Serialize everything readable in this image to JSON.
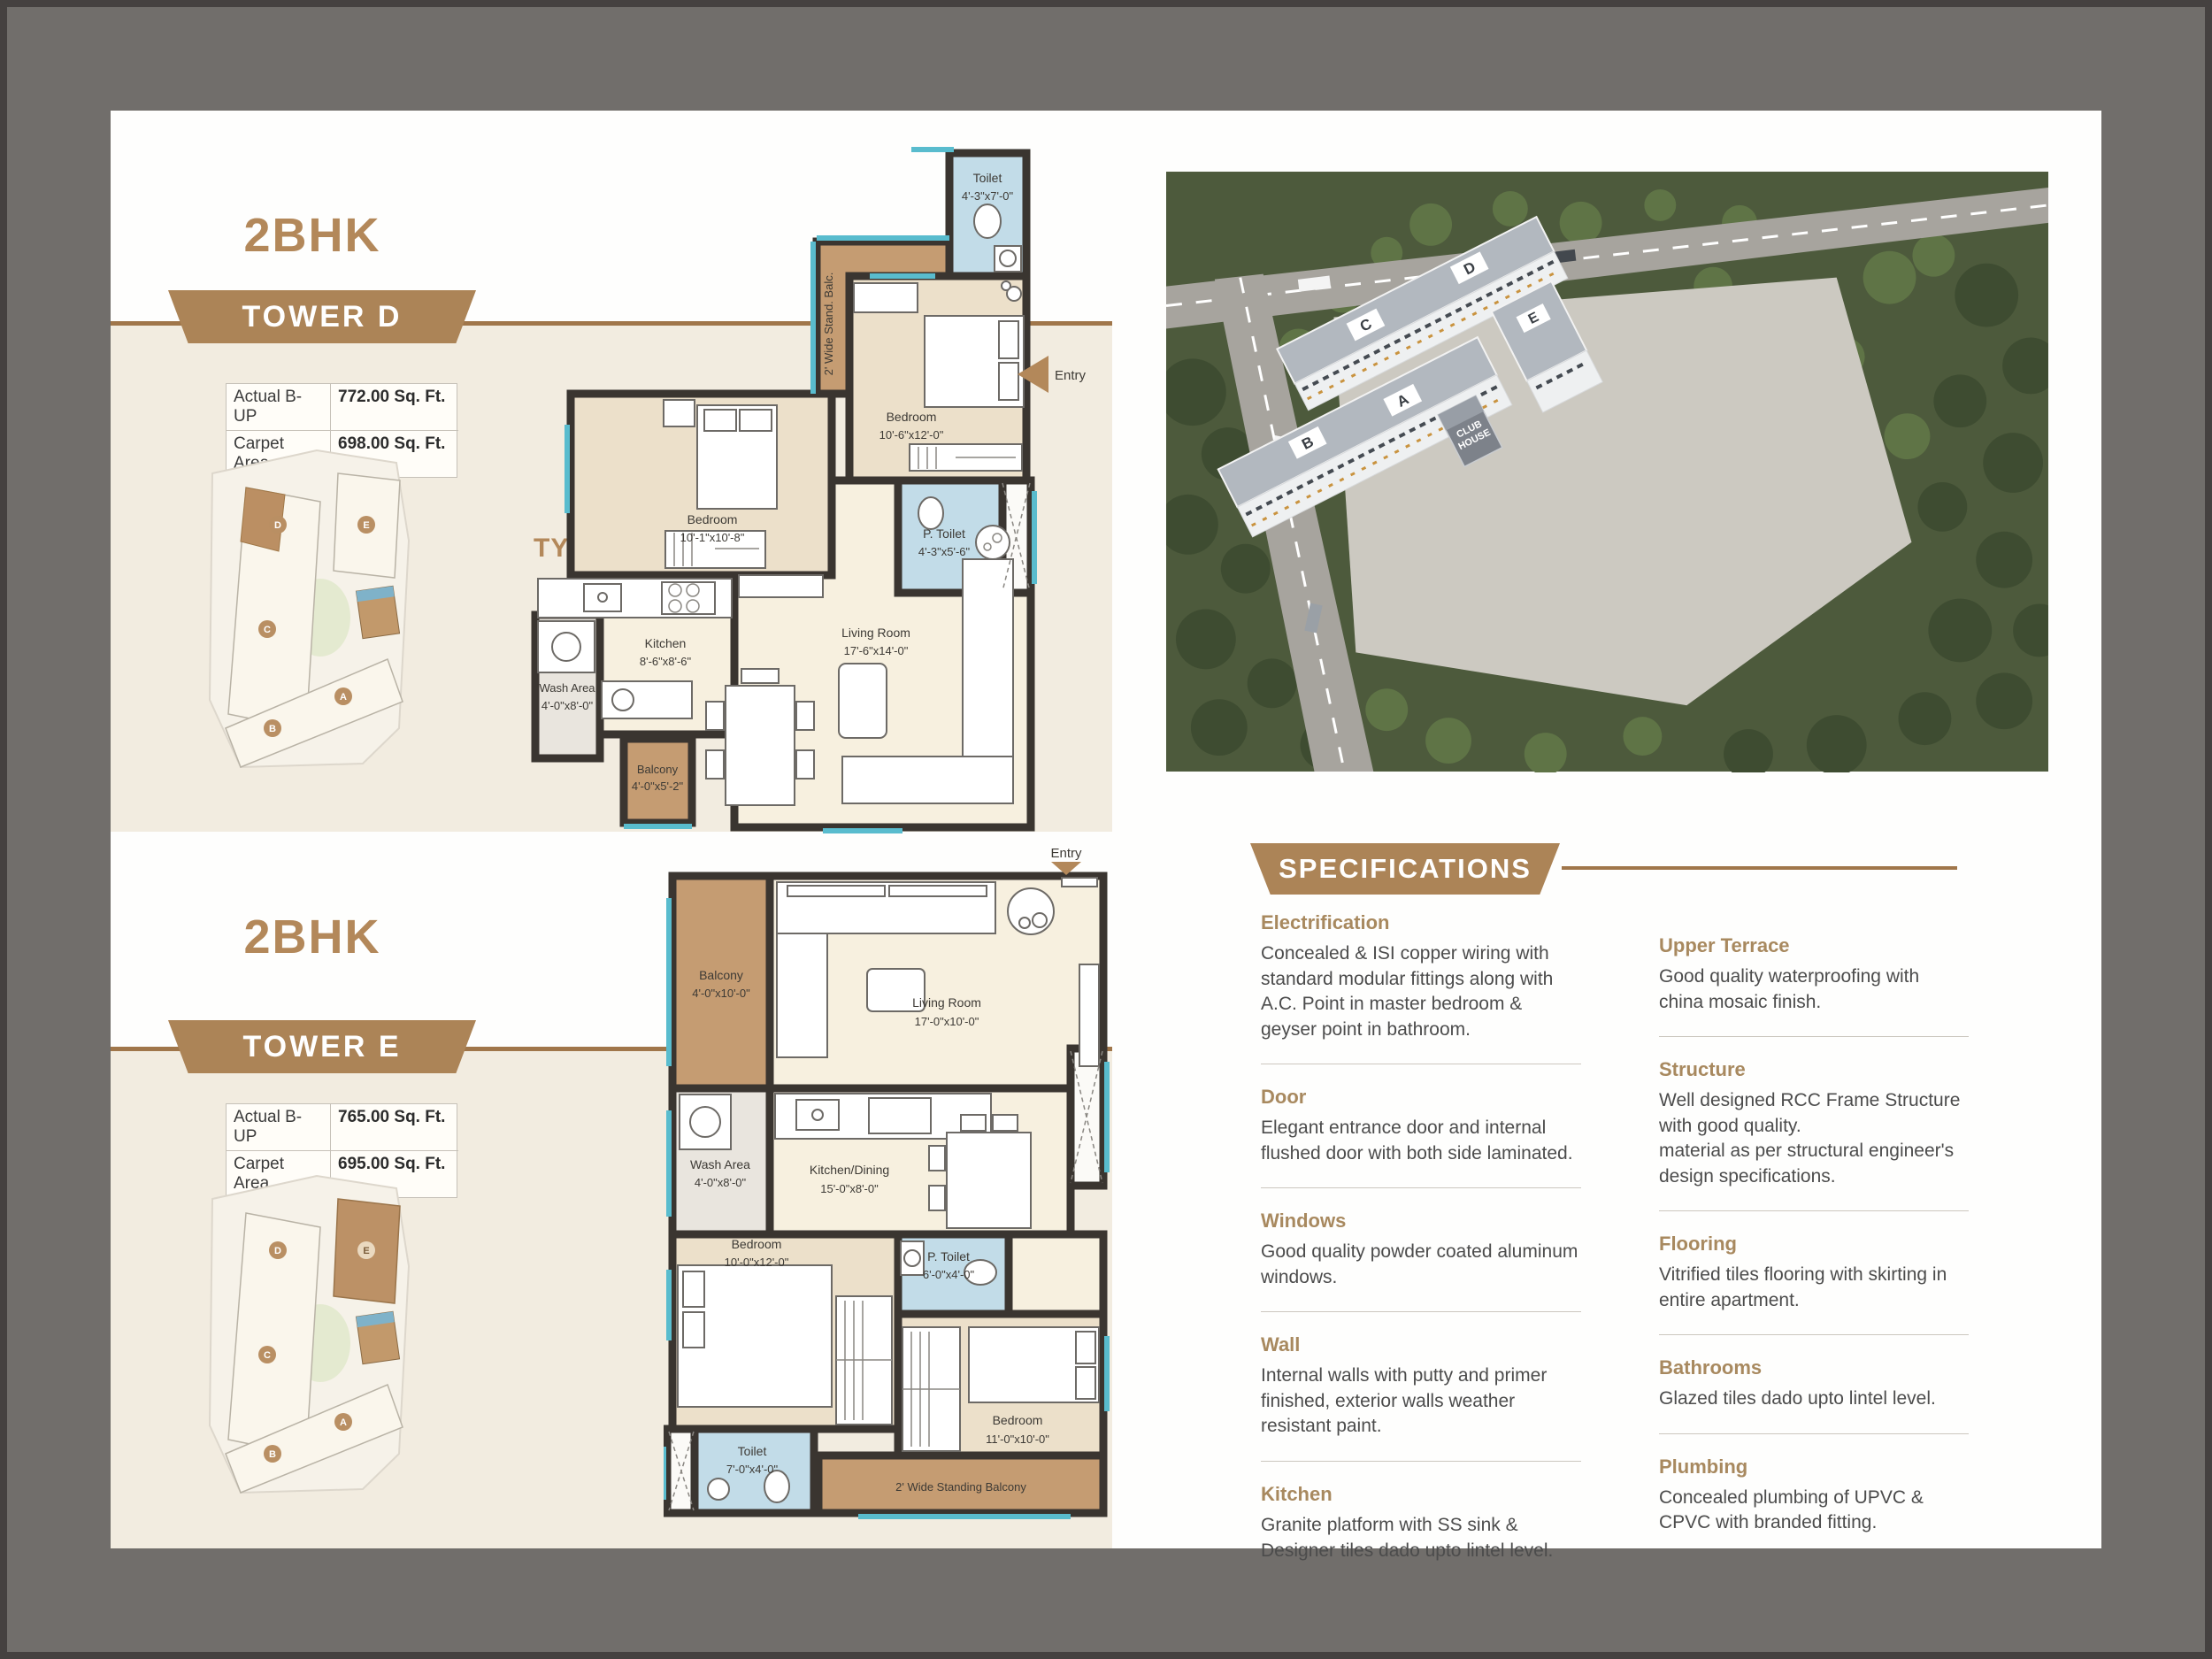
{
  "tower_d": {
    "bhk": "2BHK",
    "tower": "TOWER D",
    "type_label": "TYPE B",
    "entry_label": "Entry",
    "area_table": {
      "row1_label": "Actual B-UP",
      "row1_value": "772.00 Sq. Ft.",
      "row2_label": "Carpet Area",
      "row2_value": "698.00 Sq. Ft."
    },
    "rooms": {
      "toilet": {
        "name": "Toilet",
        "dim": "4'-3\"x7'-0\""
      },
      "stand_balc": {
        "name": "2' Wide Stand. Balc."
      },
      "bedroom_right": {
        "name": "Bedroom",
        "dim": "10'-6\"x12'-0\""
      },
      "bedroom_left": {
        "name": "Bedroom",
        "dim": "10'-1\"x10'-8\""
      },
      "p_toilet": {
        "name": "P. Toilet",
        "dim": "4'-3\"x5'-6\""
      },
      "wash": {
        "name": "Wash Area",
        "dim": "4'-0\"x8'-0\""
      },
      "kitchen": {
        "name": "Kitchen",
        "dim": "8'-6\"x8'-6\""
      },
      "living": {
        "name": "Living Room",
        "dim": "17'-6\"x14'-0\""
      },
      "balcony": {
        "name": "Balcony",
        "dim": "4'-0\"x5'-2\""
      }
    }
  },
  "tower_e": {
    "bhk": "2BHK",
    "tower": "TOWER E",
    "entry_label": "Entry",
    "area_table": {
      "row1_label": "Actual B-UP",
      "row1_value": "765.00 Sq. Ft.",
      "row2_label": "Carpet Area",
      "row2_value": "695.00 Sq. Ft."
    },
    "rooms": {
      "balcony": {
        "name": "Balcony",
        "dim": "4'-0\"x10'-0\""
      },
      "living": {
        "name": "Living Room",
        "dim": "17'-0\"x10'-0\""
      },
      "wash": {
        "name": "Wash Area",
        "dim": "4'-0\"x8'-0\""
      },
      "kitchen": {
        "name": "Kitchen/Dining",
        "dim": "15'-0\"x8'-0\""
      },
      "p_toilet": {
        "name": "P. Toilet",
        "dim": "6'-0\"x4'-0\""
      },
      "bedroom_left": {
        "name": "Bedroom",
        "dim": "10'-0\"x12'-0\""
      },
      "bedroom_right": {
        "name": "Bedroom",
        "dim": "11'-0\"x10'-0\""
      },
      "toilet": {
        "name": "Toilet",
        "dim": "7'-0\"x4'-0\""
      },
      "stand_balcony": {
        "name": "2' Wide Standing Balcony"
      }
    }
  },
  "aerial": {
    "towers": {
      "a": "A",
      "b": "B",
      "c": "C",
      "d": "D",
      "e": "E"
    },
    "club_line1": "CLUB",
    "club_line2": "HOUSE"
  },
  "specs": {
    "heading": "SPECIFICATIONS",
    "left": [
      {
        "title": "Electrification",
        "body": "Concealed & ISI copper wiring with standard modular fittings along with A.C. Point in master bedroom & geyser point in bathroom."
      },
      {
        "title": "Door",
        "body": "Elegant entrance door and internal flushed door with both side laminated."
      },
      {
        "title": "Windows",
        "body": "Good quality powder coated aluminum windows."
      },
      {
        "title": "Wall",
        "body": "Internal walls with putty and primer finished, exterior walls weather resistant paint."
      },
      {
        "title": "Kitchen",
        "body": "Granite platform with SS sink & Designer tiles dado upto lintel level."
      }
    ],
    "right": [
      {
        "title": "Upper Terrace",
        "body": "Good quality waterproofing with china mosaic finish."
      },
      {
        "title": "Structure",
        "body": "Well designed RCC Frame Structure with good quality.\nmaterial as per structural engineer's design specifications."
      },
      {
        "title": "Flooring",
        "body": "Vitrified tiles flooring with skirting in entire apartment."
      },
      {
        "title": "Bathrooms",
        "body": "Glazed tiles dado upto lintel level."
      },
      {
        "title": "Plumbing",
        "body": "Concealed plumbing of UPVC & CPVC with branded fitting."
      }
    ]
  }
}
